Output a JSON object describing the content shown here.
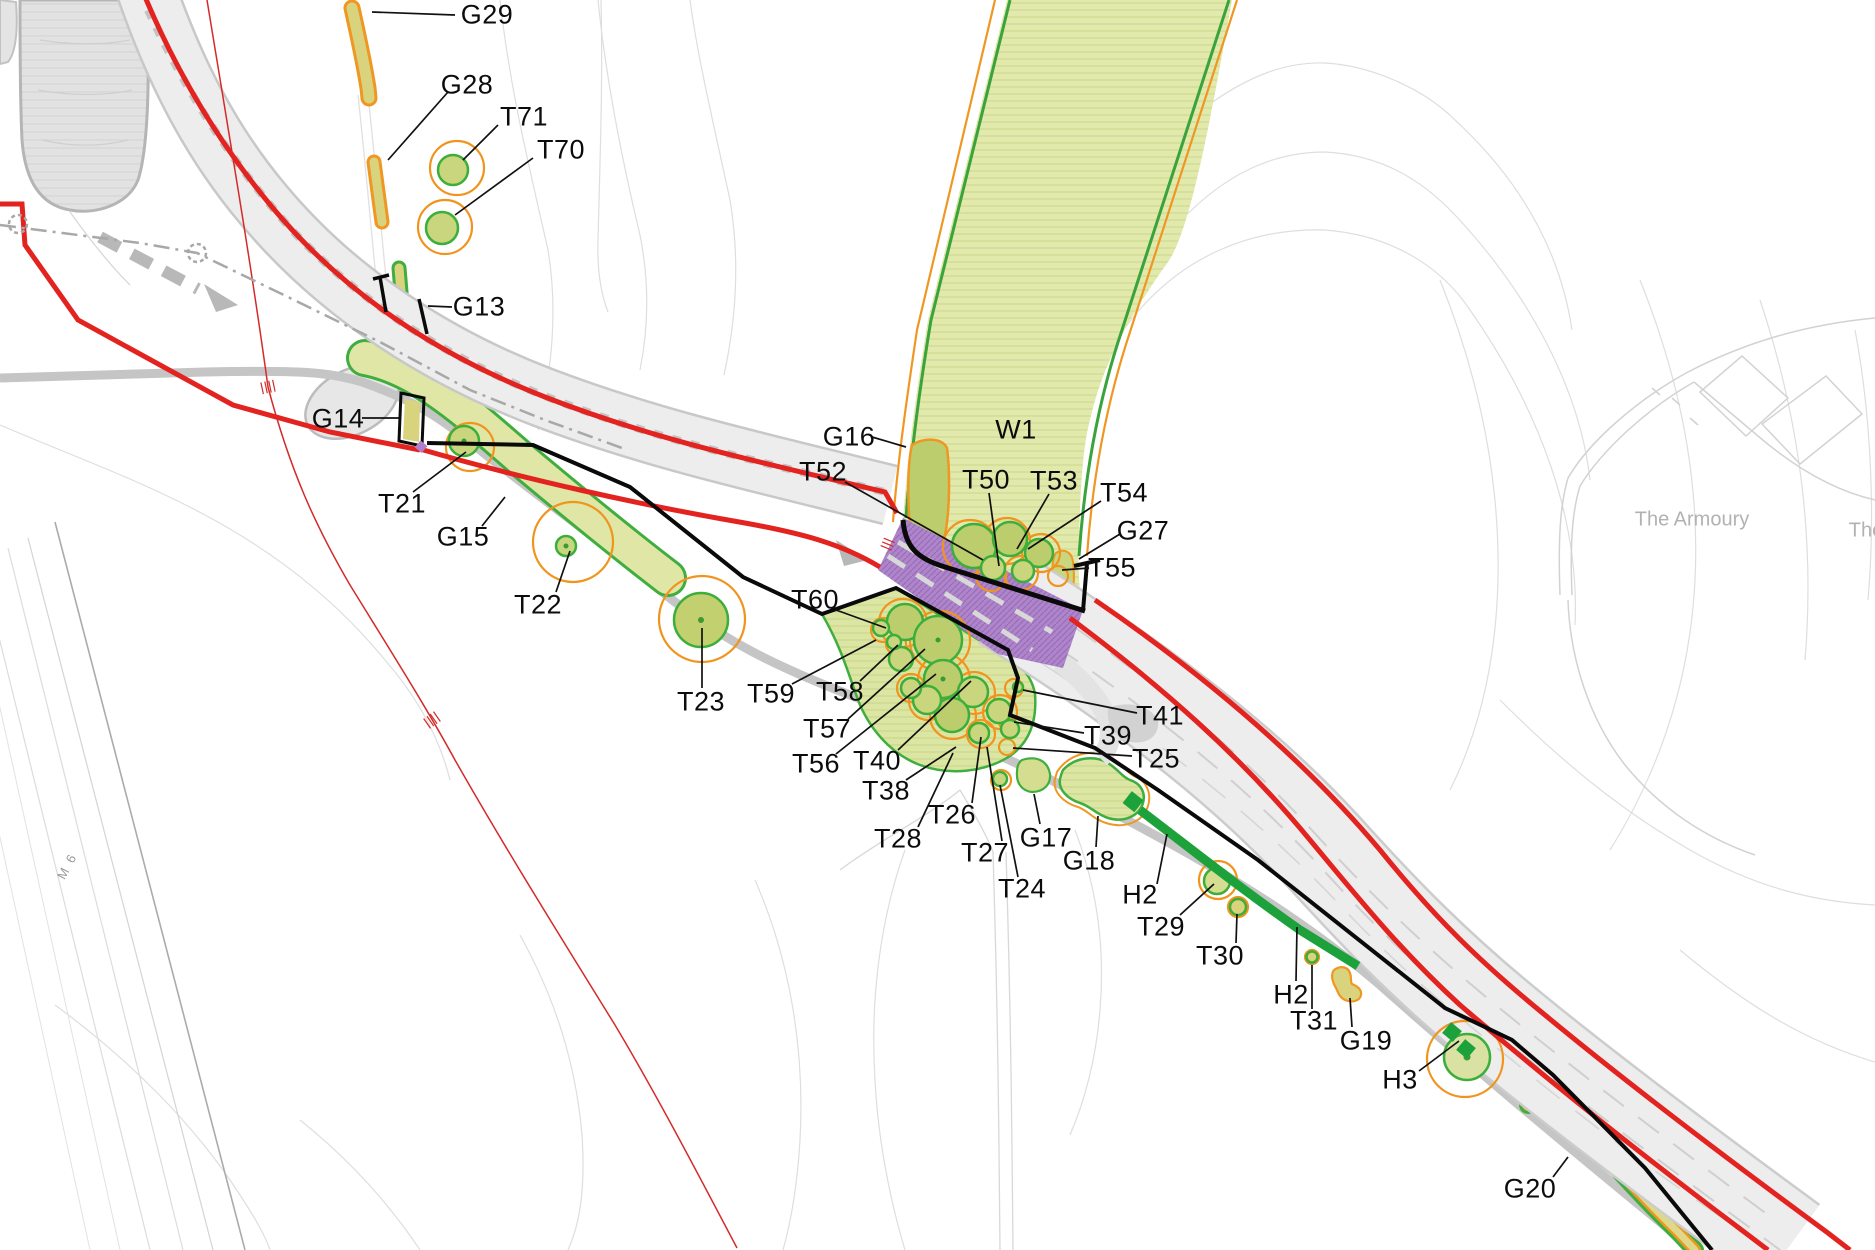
{
  "map": {
    "type": "tree-survey-site-plan",
    "woodland_label": "W1",
    "feature_labels": [
      {
        "id": "G29",
        "text": "G29"
      },
      {
        "id": "G28",
        "text": "G28"
      },
      {
        "id": "T71",
        "text": "T71"
      },
      {
        "id": "T70",
        "text": "T70"
      },
      {
        "id": "G13",
        "text": "G13"
      },
      {
        "id": "G14",
        "text": "G14"
      },
      {
        "id": "T21",
        "text": "T21"
      },
      {
        "id": "G15",
        "text": "G15"
      },
      {
        "id": "T22",
        "text": "T22"
      },
      {
        "id": "T23",
        "text": "T23"
      },
      {
        "id": "G16",
        "text": "G16"
      },
      {
        "id": "T52",
        "text": "T52"
      },
      {
        "id": "W1",
        "text": "W1"
      },
      {
        "id": "T50",
        "text": "T50"
      },
      {
        "id": "T53",
        "text": "T53"
      },
      {
        "id": "T54",
        "text": "T54"
      },
      {
        "id": "G27",
        "text": "G27"
      },
      {
        "id": "T55",
        "text": "T55"
      },
      {
        "id": "T60",
        "text": "T60"
      },
      {
        "id": "T59",
        "text": "T59"
      },
      {
        "id": "T58",
        "text": "T58"
      },
      {
        "id": "T57",
        "text": "T57"
      },
      {
        "id": "T56",
        "text": "T56"
      },
      {
        "id": "T40",
        "text": "T40"
      },
      {
        "id": "T38",
        "text": "T38"
      },
      {
        "id": "T28",
        "text": "T28"
      },
      {
        "id": "T26",
        "text": "T26"
      },
      {
        "id": "T27",
        "text": "T27"
      },
      {
        "id": "T24",
        "text": "T24"
      },
      {
        "id": "G17",
        "text": "G17"
      },
      {
        "id": "T41",
        "text": "T41"
      },
      {
        "id": "T39",
        "text": "T39"
      },
      {
        "id": "T25",
        "text": "T25"
      },
      {
        "id": "G18",
        "text": "G18"
      },
      {
        "id": "H2a",
        "text": "H2"
      },
      {
        "id": "T29",
        "text": "T29"
      },
      {
        "id": "T30",
        "text": "T30"
      },
      {
        "id": "H2b",
        "text": "H2"
      },
      {
        "id": "T31",
        "text": "T31"
      },
      {
        "id": "G19",
        "text": "G19"
      },
      {
        "id": "H3",
        "text": "H3"
      },
      {
        "id": "G20",
        "text": "G20"
      }
    ],
    "place_labels": {
      "armoury": "The Armoury",
      "armoury_partial": "The",
      "motorway": "M 6"
    },
    "colors": {
      "boundary_red": "#e2231f",
      "chainage_red": "#d42a2a",
      "survey_black": "#0a0a0a",
      "rpa_orange": "#f0941e",
      "crown_green": "#3cae3a",
      "hedge_green": "#1da23b",
      "woodland_fill": "#e1e9ad",
      "crown_fill": "#c9d67d",
      "group_strip_fill": "#d9d37e",
      "bridge_purple": "#ae85ca",
      "road_gray": "#ededed",
      "track_gray": "#c5c5c5"
    }
  }
}
